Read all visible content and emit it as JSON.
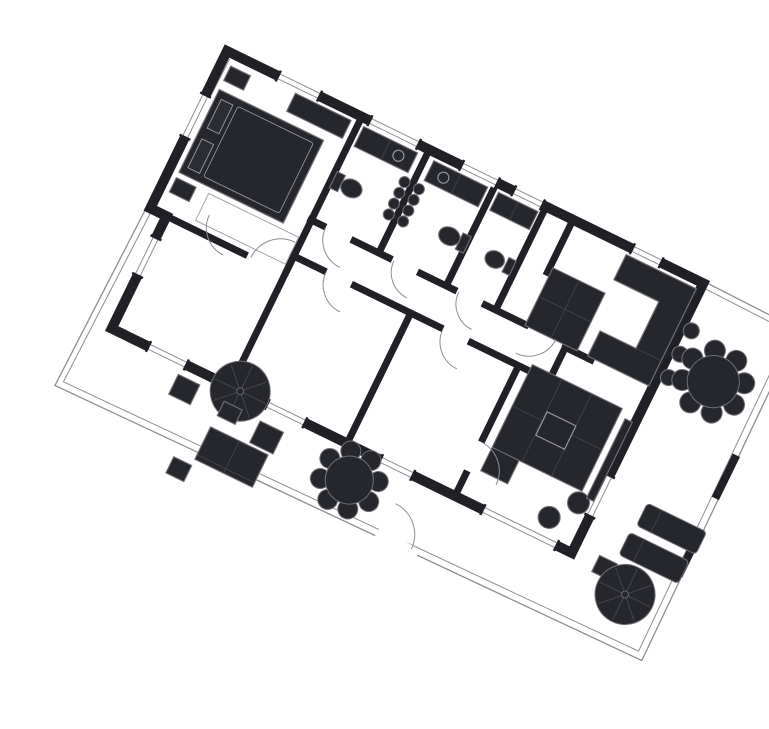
{
  "meta": {
    "label": "Rotated architectural floor plan with bedrooms, bathrooms, kitchen, living room and furnished terraces",
    "type": "floor-plan",
    "rotation_deg": 26,
    "origin": [
      187,
      35
    ]
  },
  "canvas": {
    "width": 769,
    "height": 697,
    "background": "#ffffff"
  },
  "palette": {
    "bg": "#ffffff",
    "wall": "#202127",
    "furn": "#26272c",
    "soft": "#2c2d33",
    "line": "#6f7076",
    "thin": "#8d8e93",
    "detail": "#9b9ca1",
    "inner": "#3f4046",
    "spoke": "#45464c"
  },
  "shapes": [
    {
      "n": "terrace-boundary-outer",
      "k": "polyline",
      "p": "0,-2 -8,376 640,366 636,0",
      "s": "thin",
      "sw": 1.3
    },
    {
      "n": "terrace-boundary-inner",
      "k": "polyline",
      "p": "6,6 -2,369 633,359 629,8",
      "s": "thin",
      "sw": 1
    },
    {
      "n": "right-terrace-top-wall-a",
      "k": "line",
      "x1": 530,
      "y1": -2,
      "x2": 636,
      "y2": 0,
      "s": "thin",
      "sw": 1.3
    },
    {
      "n": "right-terrace-top-wall-b",
      "k": "line",
      "x1": 530,
      "y1": 4,
      "x2": 630,
      "y2": 6,
      "s": "thin",
      "sw": 1
    },
    {
      "n": "boundary-gate-1",
      "k": "rect",
      "x": 631,
      "y": 140,
      "w": 8,
      "h": 48,
      "f": "wall",
      "s": "none"
    },
    {
      "n": "boundary-gate-2",
      "k": "rect",
      "x": 632,
      "y": 232,
      "w": 8,
      "h": 42,
      "f": "wall",
      "s": "none"
    },
    {
      "n": "wall-bedroom1-right",
      "k": "line",
      "x1": 150,
      "y1": 0,
      "x2": 150,
      "y2": 175,
      "s": "wall",
      "sw": 7
    },
    {
      "n": "wall-bath-a-b",
      "k": "line",
      "x1": 225,
      "y1": 0,
      "x2": 225,
      "y2": 118,
      "s": "wall",
      "sw": 7
    },
    {
      "n": "wall-bath-b-c",
      "k": "line",
      "x1": 300,
      "y1": 0,
      "x2": 300,
      "y2": 118,
      "s": "wall",
      "sw": 7
    },
    {
      "n": "wall-bath-c-right",
      "k": "line",
      "x1": 355,
      "y1": 0,
      "x2": 355,
      "y2": 118,
      "s": "wall",
      "sw": 7
    },
    {
      "n": "wall-hall-right",
      "k": "line",
      "x1": 385,
      "y1": 0,
      "x2": 385,
      "y2": 62,
      "s": "wall",
      "sw": 7
    },
    {
      "n": "wall-corridor-top",
      "k": "line",
      "x1": 146,
      "y1": 115,
      "x2": 434,
      "y2": 115,
      "s": "wall",
      "sw": 7
    },
    {
      "n": "wall-corridor-bottom",
      "k": "line",
      "x1": 146,
      "y1": 155,
      "x2": 434,
      "y2": 155,
      "s": "wall",
      "sw": 7
    },
    {
      "n": "wall-bedroom1-bottom",
      "k": "line",
      "x1": 0,
      "y1": 175,
      "x2": 108,
      "y2": 175,
      "s": "wall",
      "sw": 7
    },
    {
      "n": "wall-bedroom2-3",
      "k": "line",
      "x1": 150,
      "y1": 158,
      "x2": 150,
      "y2": 297,
      "s": "wall",
      "sw": 7
    },
    {
      "n": "wall-bedroom3-4",
      "k": "line",
      "x1": 280,
      "y1": 158,
      "x2": 280,
      "y2": 297,
      "s": "wall",
      "sw": 7
    },
    {
      "n": "wall-bedroom4-living",
      "k": "line",
      "x1": 400,
      "y1": 158,
      "x2": 400,
      "y2": 297,
      "s": "wall",
      "sw": 7
    },
    {
      "n": "wall-kitchen-living",
      "k": "line",
      "x1": 434,
      "y1": 118,
      "x2": 466,
      "y2": 118,
      "s": "wall",
      "sw": 7
    },
    {
      "n": "wall-corridor-end",
      "k": "line",
      "x1": 434,
      "y1": 115,
      "x2": 434,
      "y2": 158,
      "s": "wall",
      "sw": 7
    },
    {
      "n": "building-outer-wall",
      "k": "polygon",
      "p": "0,0 530,0 530,300 18,300 18,175 0,175",
      "f": "none",
      "s": "wall",
      "sw": 10
    },
    {
      "n": "door-gap-bath-a",
      "k": "line",
      "x1": 166,
      "y1": 115,
      "x2": 194,
      "y2": 115,
      "s": "bg",
      "sw": 9
    },
    {
      "n": "door-gap-bath-b",
      "k": "line",
      "x1": 240,
      "y1": 115,
      "x2": 268,
      "y2": 115,
      "s": "bg",
      "sw": 9
    },
    {
      "n": "door-gap-bath-c",
      "k": "line",
      "x1": 312,
      "y1": 115,
      "x2": 340,
      "y2": 115,
      "s": "bg",
      "sw": 9
    },
    {
      "n": "door-gap-kitchen",
      "k": "line",
      "x1": 392,
      "y1": 115,
      "x2": 430,
      "y2": 115,
      "s": "bg",
      "sw": 9
    },
    {
      "n": "door-gap-bedroom2",
      "k": "line",
      "x1": 56,
      "y1": 155,
      "x2": 84,
      "y2": 155,
      "s": "bg",
      "sw": 9
    },
    {
      "n": "door-gap-bedroom3",
      "k": "line",
      "x1": 186,
      "y1": 155,
      "x2": 214,
      "y2": 155,
      "s": "bg",
      "sw": 9
    },
    {
      "n": "door-gap-bedroom4",
      "k": "line",
      "x1": 316,
      "y1": 155,
      "x2": 344,
      "y2": 155,
      "s": "bg",
      "sw": 9
    },
    {
      "n": "door-gap-living",
      "k": "line",
      "x1": 400,
      "y1": 240,
      "x2": 400,
      "y2": 272,
      "s": "bg",
      "sw": 9
    },
    {
      "n": "door-gap-entrance",
      "k": "line",
      "x1": 346,
      "y1": 366,
      "x2": 392,
      "y2": 370,
      "s": "bg",
      "sw": 12
    },
    {
      "n": "window-top-1",
      "k": "window",
      "x": 58,
      "y": 0,
      "len": 44,
      "o": "h"
    },
    {
      "n": "window-top-2",
      "k": "window",
      "x": 160,
      "y": 0,
      "len": 52,
      "o": "h"
    },
    {
      "n": "window-top-3",
      "k": "window",
      "x": 262,
      "y": 0,
      "len": 38,
      "o": "h"
    },
    {
      "n": "window-top-4",
      "k": "window",
      "x": 320,
      "y": 0,
      "len": 30,
      "o": "h"
    },
    {
      "n": "window-top-5",
      "k": "window",
      "x": 452,
      "y": 0,
      "len": 30,
      "o": "h"
    },
    {
      "n": "window-bottom-1",
      "k": "window",
      "x": 60,
      "y": 300,
      "len": 40,
      "o": "h"
    },
    {
      "n": "window-bottom-2",
      "k": "window",
      "x": 192,
      "y": 300,
      "len": 40,
      "o": "h"
    },
    {
      "n": "window-bottom-3",
      "k": "window",
      "x": 318,
      "y": 300,
      "len": 34,
      "o": "h"
    },
    {
      "n": "window-bottom-4",
      "k": "window",
      "x": 432,
      "y": 300,
      "len": 80,
      "o": "h"
    },
    {
      "n": "window-right",
      "k": "window",
      "x": 530,
      "y": 215,
      "len": 43,
      "o": "v"
    },
    {
      "n": "window-left-1",
      "k": "window",
      "x": 0,
      "y": 50,
      "len": 45,
      "o": "v"
    },
    {
      "n": "window-left-2",
      "k": "window",
      "x": 18,
      "y": 200,
      "len": 40,
      "o": "v"
    },
    {
      "n": "wardrobe-bedroom1",
      "k": "rect",
      "x": 80,
      "y": 8,
      "w": 62,
      "h": 20
    },
    {
      "n": "bed-1",
      "k": "bed",
      "x": 10,
      "y": 38,
      "w": 116,
      "h": 92
    },
    {
      "n": "nightstand-1a",
      "k": "rect",
      "x": 10,
      "y": 12,
      "w": 22,
      "h": 16
    },
    {
      "n": "nightstand-1b",
      "k": "rect",
      "x": 10,
      "y": 136,
      "w": 22,
      "h": 16
    },
    {
      "n": "rug-bedroom1",
      "k": "rect",
      "x": 46,
      "y": 136,
      "w": 100,
      "h": 30,
      "f": "none",
      "s": "detail",
      "sw": 0.9
    },
    {
      "n": "vanity-bath-a",
      "k": "grid",
      "x": 156,
      "y": 8,
      "w": 60,
      "h": 22,
      "c": 2,
      "rr": 1
    },
    {
      "n": "sink-bath-a",
      "k": "circle",
      "cx": 200,
      "cy": 19,
      "r": 5.5,
      "f": "none",
      "s": "detail"
    },
    {
      "n": "toilet-tank-a",
      "k": "rect",
      "x": 152,
      "y": 60,
      "w": 9,
      "h": 18
    },
    {
      "n": "toilet-bowl-a",
      "k": "ellipse",
      "cx": 172,
      "cy": 69,
      "rx": 11,
      "ry": 9
    },
    {
      "n": "radiator-bath-a",
      "k": "scallops",
      "x": 217,
      "y": 40,
      "nn": 4,
      "dy": 12,
      "r": 5.5
    },
    {
      "n": "vanity-bath-b",
      "k": "grid",
      "x": 234,
      "y": 8,
      "w": 60,
      "h": 22,
      "c": 2,
      "rr": 1
    },
    {
      "n": "sink-bath-b",
      "k": "circle",
      "cx": 250,
      "cy": 19,
      "r": 5.5,
      "f": "none",
      "s": "detail"
    },
    {
      "n": "toilet-tank-b",
      "k": "rect",
      "x": 292,
      "y": 60,
      "w": 9,
      "h": 18
    },
    {
      "n": "toilet-bowl-b",
      "k": "ellipse",
      "cx": 281,
      "cy": 69,
      "rx": 11,
      "ry": 9
    },
    {
      "n": "radiator-bath-b",
      "k": "scallops",
      "x": 233,
      "y": 40,
      "nn": 4,
      "dy": 12,
      "r": 5.5
    },
    {
      "n": "vanity-bath-c",
      "k": "grid",
      "x": 306,
      "y": 8,
      "w": 44,
      "h": 20,
      "c": 2,
      "rr": 1
    },
    {
      "n": "toilet-tank-c",
      "k": "rect",
      "x": 344,
      "y": 62,
      "w": 8,
      "h": 16
    },
    {
      "n": "toilet-bowl-c",
      "k": "ellipse",
      "cx": 332,
      "cy": 70,
      "rx": 10,
      "ry": 8.5
    },
    {
      "n": "kitchen-counter",
      "k": "grid",
      "x": 388,
      "y": 52,
      "w": 58,
      "h": 64,
      "c": 2,
      "rr": 2
    },
    {
      "n": "kitchen-u-counter",
      "k": "polygon",
      "p": "448,8 526,8 526,116 458,116 458,88 498,88 498,36 448,36",
      "f": "furn",
      "s": "line",
      "sw": 1.2
    },
    {
      "n": "kitchen-u-counter-line",
      "k": "line",
      "x1": 498,
      "y1": 88,
      "x2": 526,
      "y2": 88,
      "s": "inner",
      "sw": 1
    },
    {
      "n": "bar-stool-1",
      "k": "circle",
      "cx": 540,
      "cy": 48,
      "r": 8
    },
    {
      "n": "bar-stool-2",
      "k": "circle",
      "cx": 540,
      "cy": 74,
      "r": 8
    },
    {
      "n": "bar-stool-3",
      "k": "circle",
      "cx": 540,
      "cy": 100,
      "r": 8
    },
    {
      "n": "sofa-sectional",
      "k": "rect",
      "x": 412,
      "y": 148,
      "w": 100,
      "h": 92
    },
    {
      "n": "sofa-cushion-line-1",
      "k": "line",
      "x1": 445,
      "y1": 148,
      "x2": 445,
      "y2": 240,
      "s": "inner",
      "sw": 1
    },
    {
      "n": "sofa-cushion-line-2",
      "k": "line",
      "x1": 478,
      "y1": 148,
      "x2": 478,
      "y2": 240,
      "s": "inner",
      "sw": 1
    },
    {
      "n": "sofa-cushion-line-3",
      "k": "line",
      "x1": 412,
      "y1": 194,
      "x2": 512,
      "y2": 194,
      "s": "inner",
      "sw": 1
    },
    {
      "n": "coffee-table",
      "k": "rect",
      "x": 446,
      "y": 184,
      "w": 32,
      "h": 26,
      "s": "detail"
    },
    {
      "n": "sofa-side-table",
      "k": "rect",
      "x": 412,
      "y": 240,
      "w": 30,
      "h": 26
    },
    {
      "n": "pouf-1",
      "k": "circle",
      "cx": 514,
      "cy": 252,
      "r": 11
    },
    {
      "n": "pouf-2",
      "k": "circle",
      "cx": 494,
      "cy": 278,
      "r": 11
    },
    {
      "n": "tv-bench",
      "k": "rect",
      "x": 519,
      "y": 156,
      "w": 8,
      "h": 88
    },
    {
      "n": "dining-table-right",
      "k": "flower",
      "cx": 582,
      "cy": 84,
      "r": 26,
      "cr": 10.5,
      "d": 31,
      "nn": 8
    },
    {
      "n": "lounger-1",
      "k": "lounger",
      "x": 576,
      "y": 222,
      "w": 66,
      "h": 25
    },
    {
      "n": "lounger-2",
      "k": "lounger",
      "x": 573,
      "y": 256,
      "w": 66,
      "h": 25
    },
    {
      "n": "lounger-side-table",
      "k": "rect",
      "x": 556,
      "y": 290,
      "w": 20,
      "h": 18
    },
    {
      "n": "parasol-southeast",
      "k": "parasol",
      "cx": 596,
      "cy": 314,
      "r": 30
    },
    {
      "n": "terrace-stool-1",
      "k": "rect",
      "x": 98,
      "y": 312,
      "w": 24,
      "h": 22
    },
    {
      "n": "terrace-stool-2",
      "k": "rect",
      "x": 130,
      "y": 388,
      "w": 20,
      "h": 18
    },
    {
      "n": "parasol-west",
      "k": "parasol",
      "cx": 161,
      "cy": 300,
      "r": 30
    },
    {
      "n": "parasol-west-base",
      "k": "rect",
      "x": 151,
      "y": 316,
      "w": 20,
      "h": 16
    },
    {
      "n": "terrace-side-table",
      "k": "rect",
      "x": 192,
      "y": 318,
      "w": 26,
      "h": 24
    },
    {
      "n": "terrace-sofa",
      "k": "rect",
      "x": 150,
      "y": 345,
      "w": 64,
      "h": 36
    },
    {
      "n": "terrace-sofa-divider",
      "k": "line",
      "x1": 182,
      "y1": 345,
      "x2": 182,
      "y2": 381,
      "s": "inner",
      "sw": 1
    },
    {
      "n": "terrace-sofa-back",
      "k": "line",
      "x1": 150,
      "y1": 376,
      "x2": 214,
      "y2": 376,
      "s": "inner",
      "sw": 1
    },
    {
      "n": "dining-table-south",
      "k": "flower",
      "cx": 298,
      "cy": 332,
      "r": 24,
      "cr": 10,
      "d": 29,
      "nn": 8
    },
    {
      "n": "door-arc-bedroom1",
      "k": "arc",
      "cx": 145,
      "cy": 175,
      "r": 33,
      "a0": 180,
      "a1": 270
    },
    {
      "n": "door-arc-bath-a",
      "k": "arc",
      "cx": 196,
      "cy": 115,
      "r": 30,
      "a0": 90,
      "a1": 180
    },
    {
      "n": "door-arc-bath-b",
      "k": "arc",
      "cx": 270,
      "cy": 115,
      "r": 28,
      "a0": 90,
      "a1": 180
    },
    {
      "n": "door-arc-bath-c",
      "k": "arc",
      "cx": 342,
      "cy": 115,
      "r": 28,
      "a0": 90,
      "a1": 180
    },
    {
      "n": "door-arc-kitchen",
      "k": "arc",
      "cx": 392,
      "cy": 115,
      "r": 30,
      "a0": 0,
      "a1": 90
    },
    {
      "n": "door-arc-bedroom2",
      "k": "arc",
      "cx": 86,
      "cy": 155,
      "r": 30,
      "a0": 90,
      "a1": 180
    },
    {
      "n": "door-arc-bedroom3",
      "k": "arc",
      "cx": 216,
      "cy": 155,
      "r": 30,
      "a0": 90,
      "a1": 180
    },
    {
      "n": "door-arc-bedroom4",
      "k": "arc",
      "cx": 346,
      "cy": 155,
      "r": 30,
      "a0": 90,
      "a1": 180
    },
    {
      "n": "door-arc-living",
      "k": "arc",
      "cx": 400,
      "cy": 272,
      "r": 32,
      "a0": 270,
      "a1": 360
    },
    {
      "n": "door-arc-entrance",
      "k": "arc",
      "cx": 350,
      "cy": 367,
      "r": 34,
      "a0": 270,
      "a1": 360
    }
  ]
}
